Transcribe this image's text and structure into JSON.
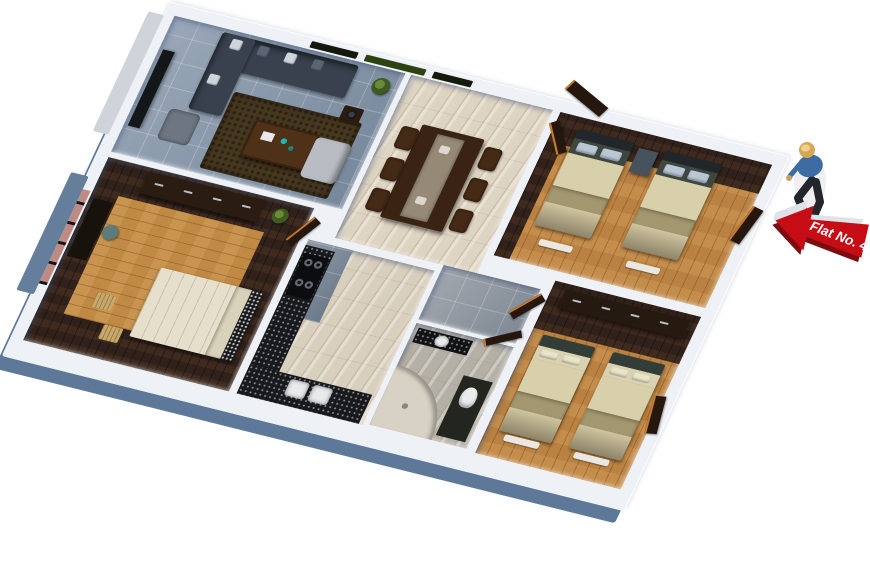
{
  "scene": {
    "description": "3d-rendered-apartment-floor-plan-top-view",
    "background": "#ffffff"
  },
  "sign": {
    "label": "Flat No. 4",
    "direction": "left",
    "arrow_color": "#c60d16",
    "arrow_shadow_color": "#7d0b0f",
    "arrow_back_color": "#dfe3e8",
    "text_color": "#ffffff"
  },
  "person": {
    "helmet_color": "#d7a853",
    "shirt_color": "#3d6ca5",
    "pants_color": "#23262b",
    "skin_color": "#c9a06a"
  },
  "palette": {
    "wall": "#eef1f6",
    "wall_exterior": "#5d7898",
    "wood_floor": "#ba8242",
    "walnut_floor": "#30211a",
    "marble_floor": "#ded4c2",
    "tile_blue_gray": "#8c9cae",
    "tile_gray": "#959ca4",
    "counter_black": "#17191d",
    "sofa": "#38414d",
    "rug": "#46371f",
    "bedding_cream": "#d8cfab",
    "bedding_band": "#a3976f",
    "furniture_walnut": "#2b1c11",
    "door_orange": "#c87a26",
    "window_green": "#2c430f"
  },
  "rooms": [
    {
      "name": "living-room",
      "floor": "#8c9cae"
    },
    {
      "name": "dining-hall",
      "floor": "#ded4c2"
    },
    {
      "name": "bedroom-top-right",
      "floor": "#ba8242"
    },
    {
      "name": "master-bedroom",
      "floor": "#30211a"
    },
    {
      "name": "kitchen",
      "floor": "#d9cfbd"
    },
    {
      "name": "corridor",
      "floor": "#959ca4"
    },
    {
      "name": "bathroom",
      "floor": "#b4b0a6"
    },
    {
      "name": "bedroom-bottom-right",
      "floor": "#ba8242"
    }
  ]
}
